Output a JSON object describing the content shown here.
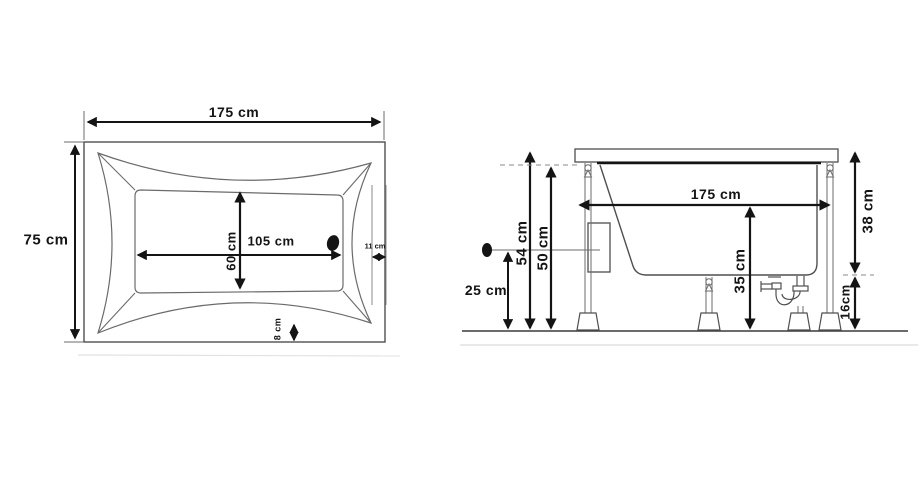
{
  "diagram": {
    "subject": "bathtub technical drawing with dimensions",
    "views": [
      "top view",
      "side view"
    ],
    "plan_view": {
      "outer_width_label": "175 cm",
      "outer_depth_label": "75 cm",
      "inner_length_label": "105 cm",
      "inner_width_label": "60 cm",
      "rim_right_label": "11 cm",
      "rim_bottom_label": "8 cm"
    },
    "side_view": {
      "length_label": "175 cm",
      "overall_height_label": "54 cm",
      "shell_height_label": "50 cm",
      "drain_outlet_height_label": "25 cm",
      "inner_height_label": "35 cm",
      "body_height_label": "38 cm",
      "clearance_label": "16cm"
    }
  },
  "colors": {
    "ink": "#141414",
    "line": "#4a4a4a",
    "thin_line": "#6b6b6b",
    "ground": "#333333",
    "scan_artifact": "#d9d9d9"
  }
}
